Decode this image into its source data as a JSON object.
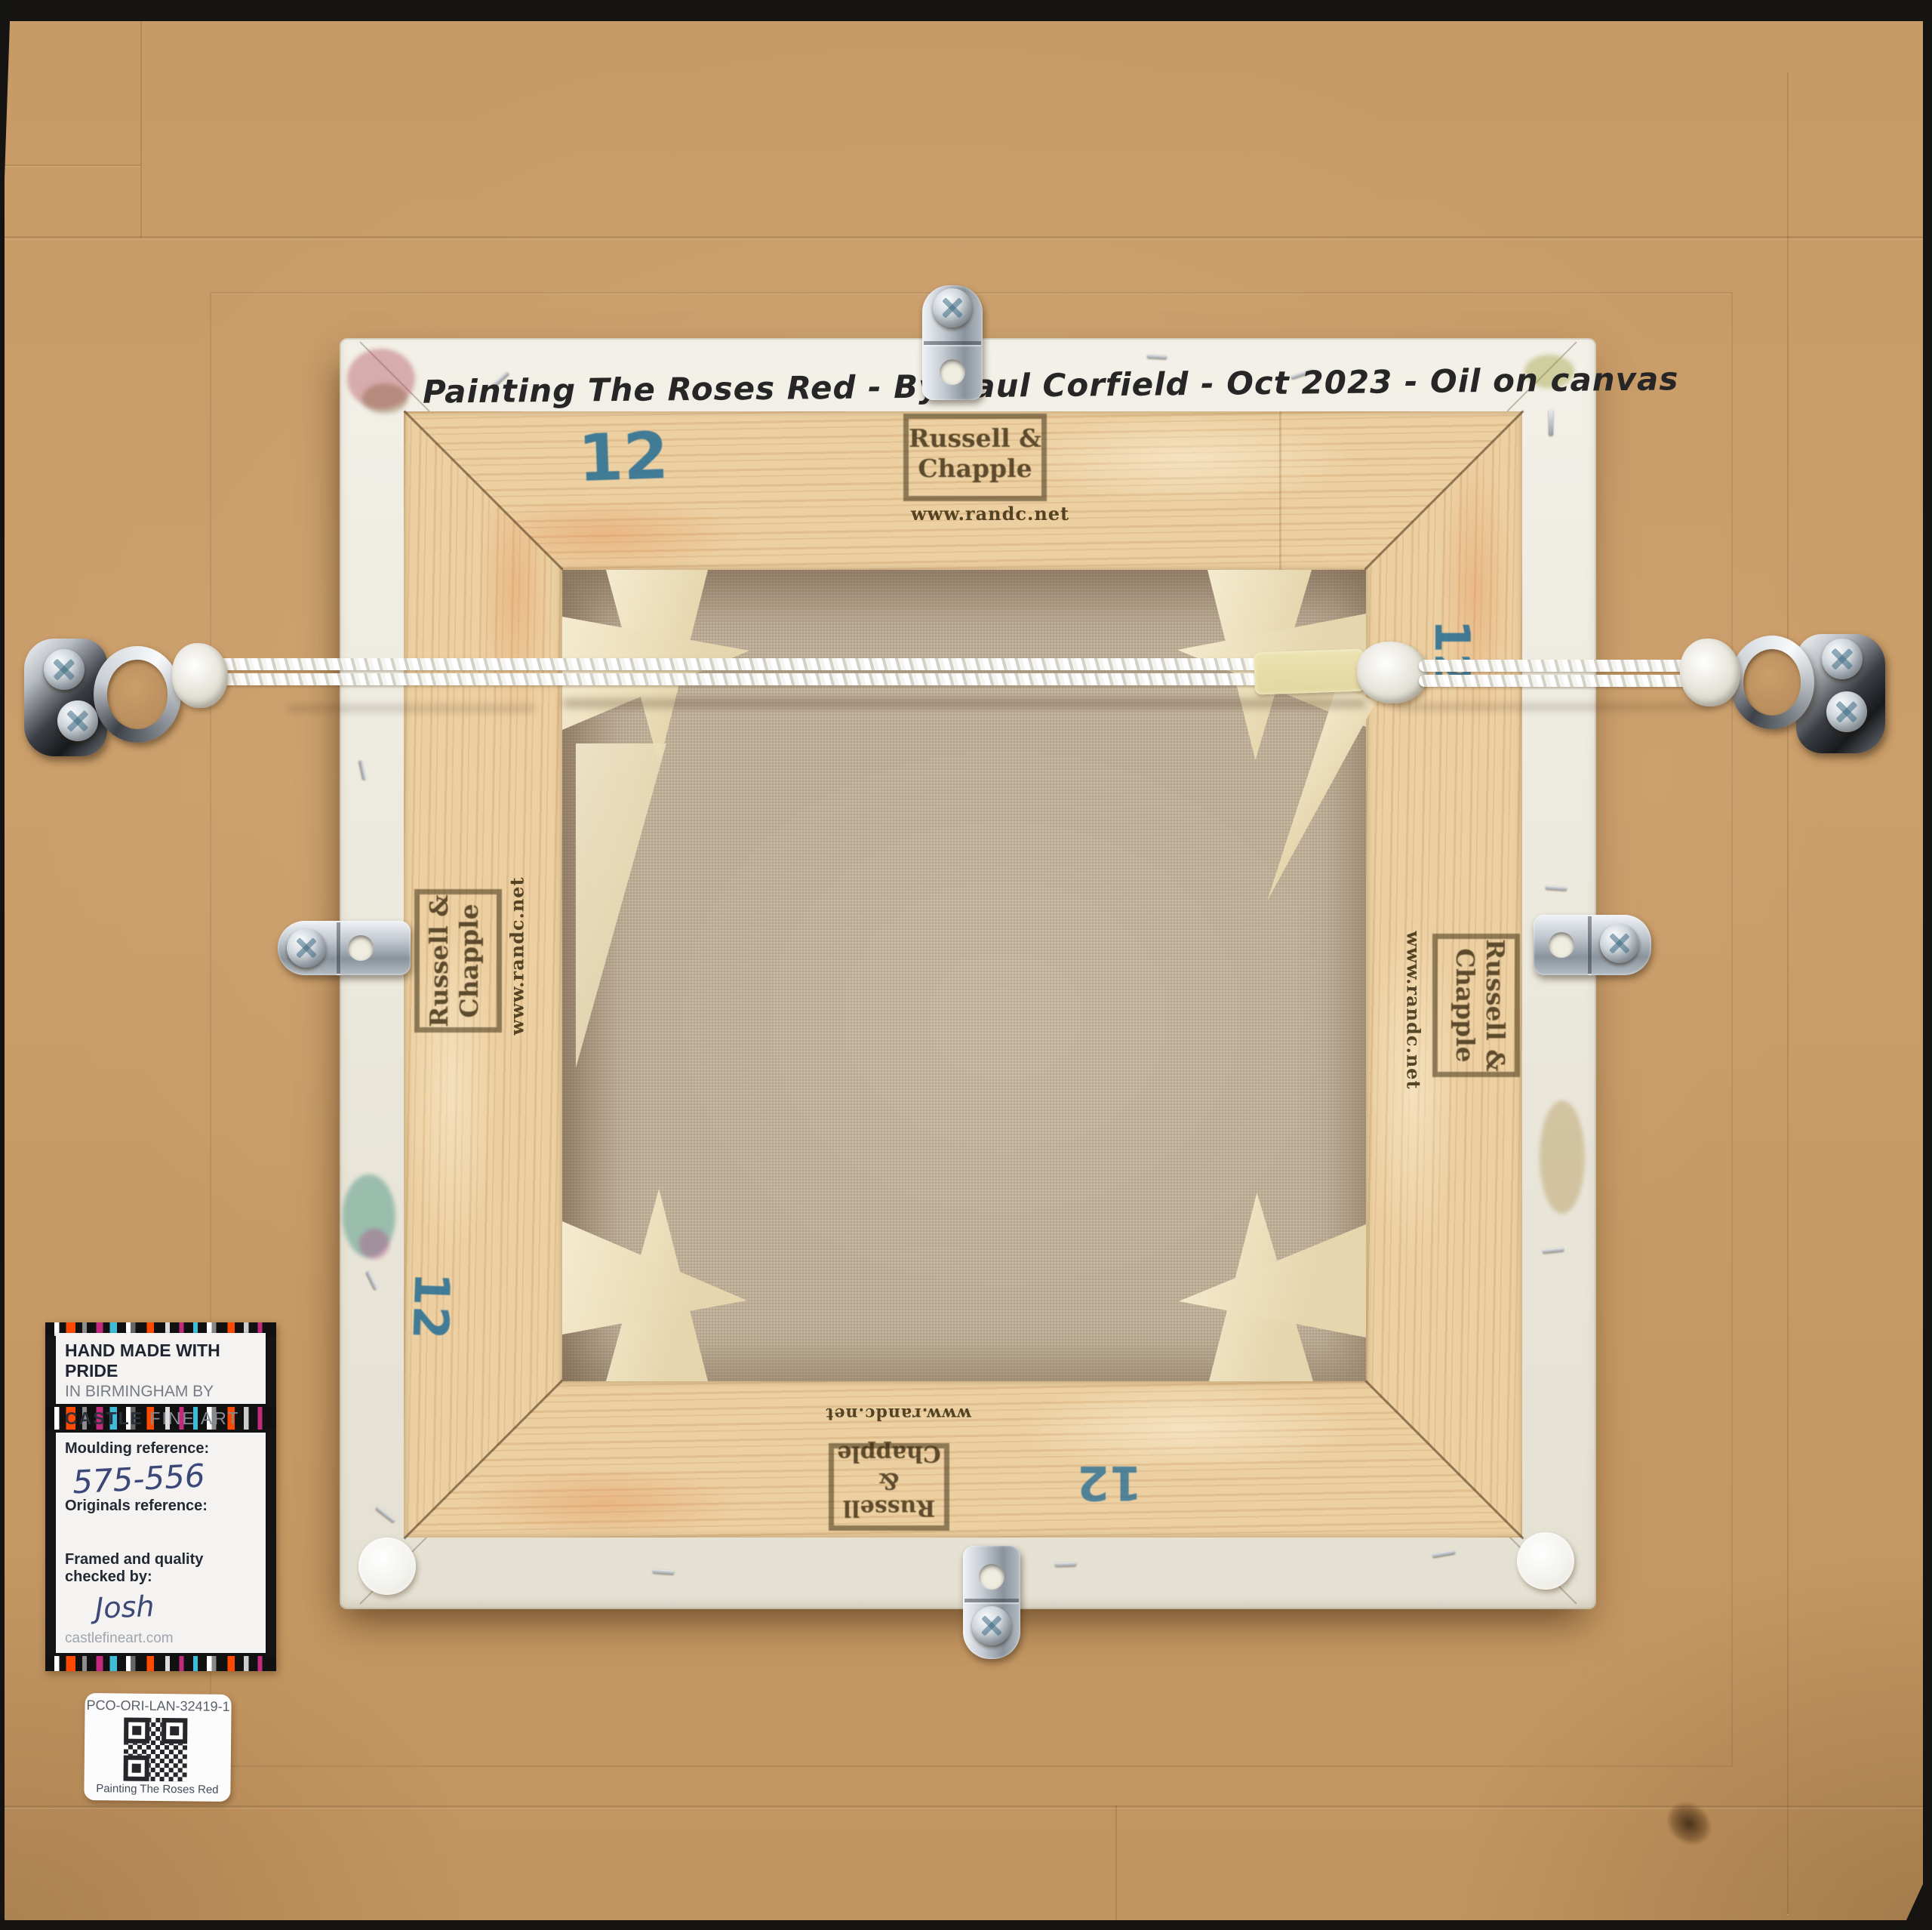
{
  "artwork": {
    "handwritten_title": "Painting The Roses Red - By Paul Corfield - Oct 2023 - Oil on canvas"
  },
  "stretcher": {
    "size_mark": "12",
    "stamp_line1": "Russell &",
    "stamp_line2": "Chapple",
    "stamp_url": "www.randc.net"
  },
  "label": {
    "heading": "HAND MADE WITH PRIDE",
    "subheading": "IN BIRMINGHAM BY",
    "brand_bold": "CASTLE",
    "brand_light": "FINE ART",
    "moulding_label": "Moulding reference:",
    "moulding_value": "575-556",
    "originals_label": "Originals reference:",
    "originals_value": "",
    "checked_label": "Framed and quality checked by:",
    "checked_value": "Josh",
    "website": "castlefineart.com"
  },
  "sticker": {
    "code": "PCO-ORI-LAN-32419-1",
    "caption": "Painting The Roses Red"
  },
  "colors": {
    "cardboard": "#c79a66",
    "wood": "#ecd0a2",
    "canvas_recess": "#c3b199",
    "canvas_edge": "#efece2",
    "size_mark_blue": "#2a7095",
    "stamp_brown": "#3a2a0e",
    "label_orange": "#ff4a00",
    "label_magenta": "#c22a7d",
    "label_cyan": "#3fbcd9",
    "ink_blue": "#3c4878"
  }
}
